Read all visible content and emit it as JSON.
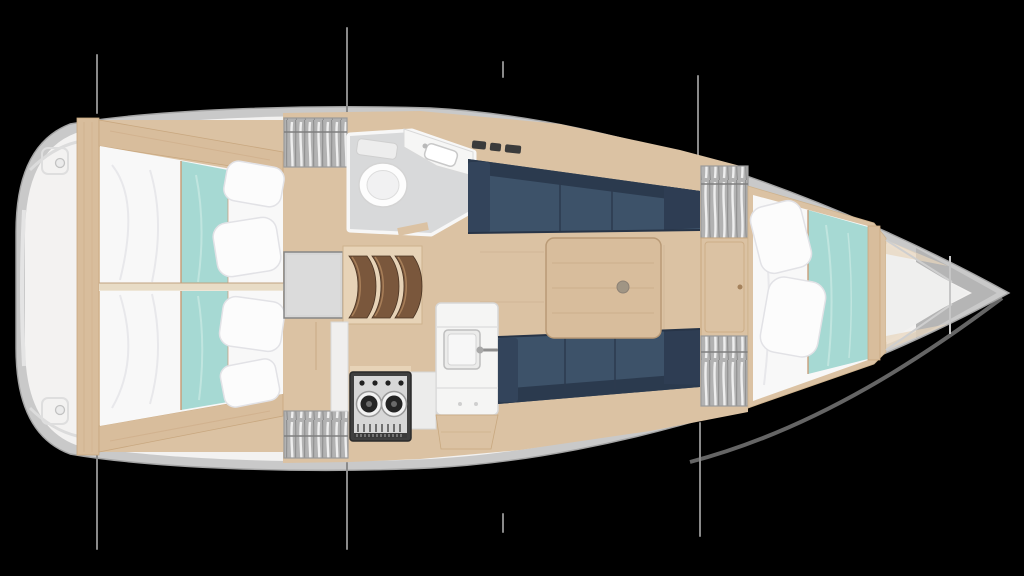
{
  "page": {
    "background": "#000000"
  },
  "plan": {
    "title": "sailing-yacht-interior-floor-plan",
    "view": "top-down",
    "orientation": "bow-right",
    "colors": {
      "hullBand": "#c9c9c9",
      "hullEdge": "#a4a4a4",
      "deck": "#f3f2f1",
      "bowShadow": "#b5b5b5",
      "woodFloor": "#dbc2a3",
      "woodTrim": "#e7d3b7",
      "woodBeam": "#d8bd9c",
      "woodLine": "#c8a87f",
      "stepWood": "#7a573c",
      "navy": "#3d5269",
      "navyDark": "#2b3a4e",
      "teal": "#a6d9d3",
      "tealPiping": "#c89a74",
      "bedding": "#f8f8f8",
      "pillow": "#fcfcfc",
      "pillowEdge": "#e2e2e6",
      "headFloor": "#d8d9da",
      "fixtureWhite": "#f5f5f4",
      "applianceDark": "#3f3f3f",
      "burnerDark": "#242424",
      "lockerBase": "#b2b2b2",
      "engineHatch": "#d6d6d6",
      "rigging": "#8a8a8a"
    },
    "regions": [
      {
        "id": "transom-swim-platform",
        "label": "Transom swim platform"
      },
      {
        "id": "aft-cabin-port",
        "label": "Aft double cabin (port)"
      },
      {
        "id": "aft-cabin-starboard",
        "label": "Aft double cabin (starboard)"
      },
      {
        "id": "hanging-locker-aft-port",
        "label": "Hanging locker aft port"
      },
      {
        "id": "hanging-locker-galley",
        "label": "Hanging locker aft starboard"
      },
      {
        "id": "engine-hatch",
        "label": "Engine box / companionway landing"
      },
      {
        "id": "companionway-steps",
        "label": "Companionway steps"
      },
      {
        "id": "head",
        "label": "Head with toilet and washbasin"
      },
      {
        "id": "galley",
        "label": "Galley with stove and sink"
      },
      {
        "id": "salon",
        "label": "Salon with settees and table"
      },
      {
        "id": "hanging-locker-forward-port",
        "label": "Hanging locker forward port"
      },
      {
        "id": "hanging-locker-forward-starboard",
        "label": "Hanging locker forward starboard"
      },
      {
        "id": "forward-cabin",
        "label": "Forward V-berth cabin"
      },
      {
        "id": "anchor-locker",
        "label": "Anchor locker"
      },
      {
        "id": "shroud-lines",
        "label": "Standing rigging chainplate lines"
      }
    ]
  }
}
